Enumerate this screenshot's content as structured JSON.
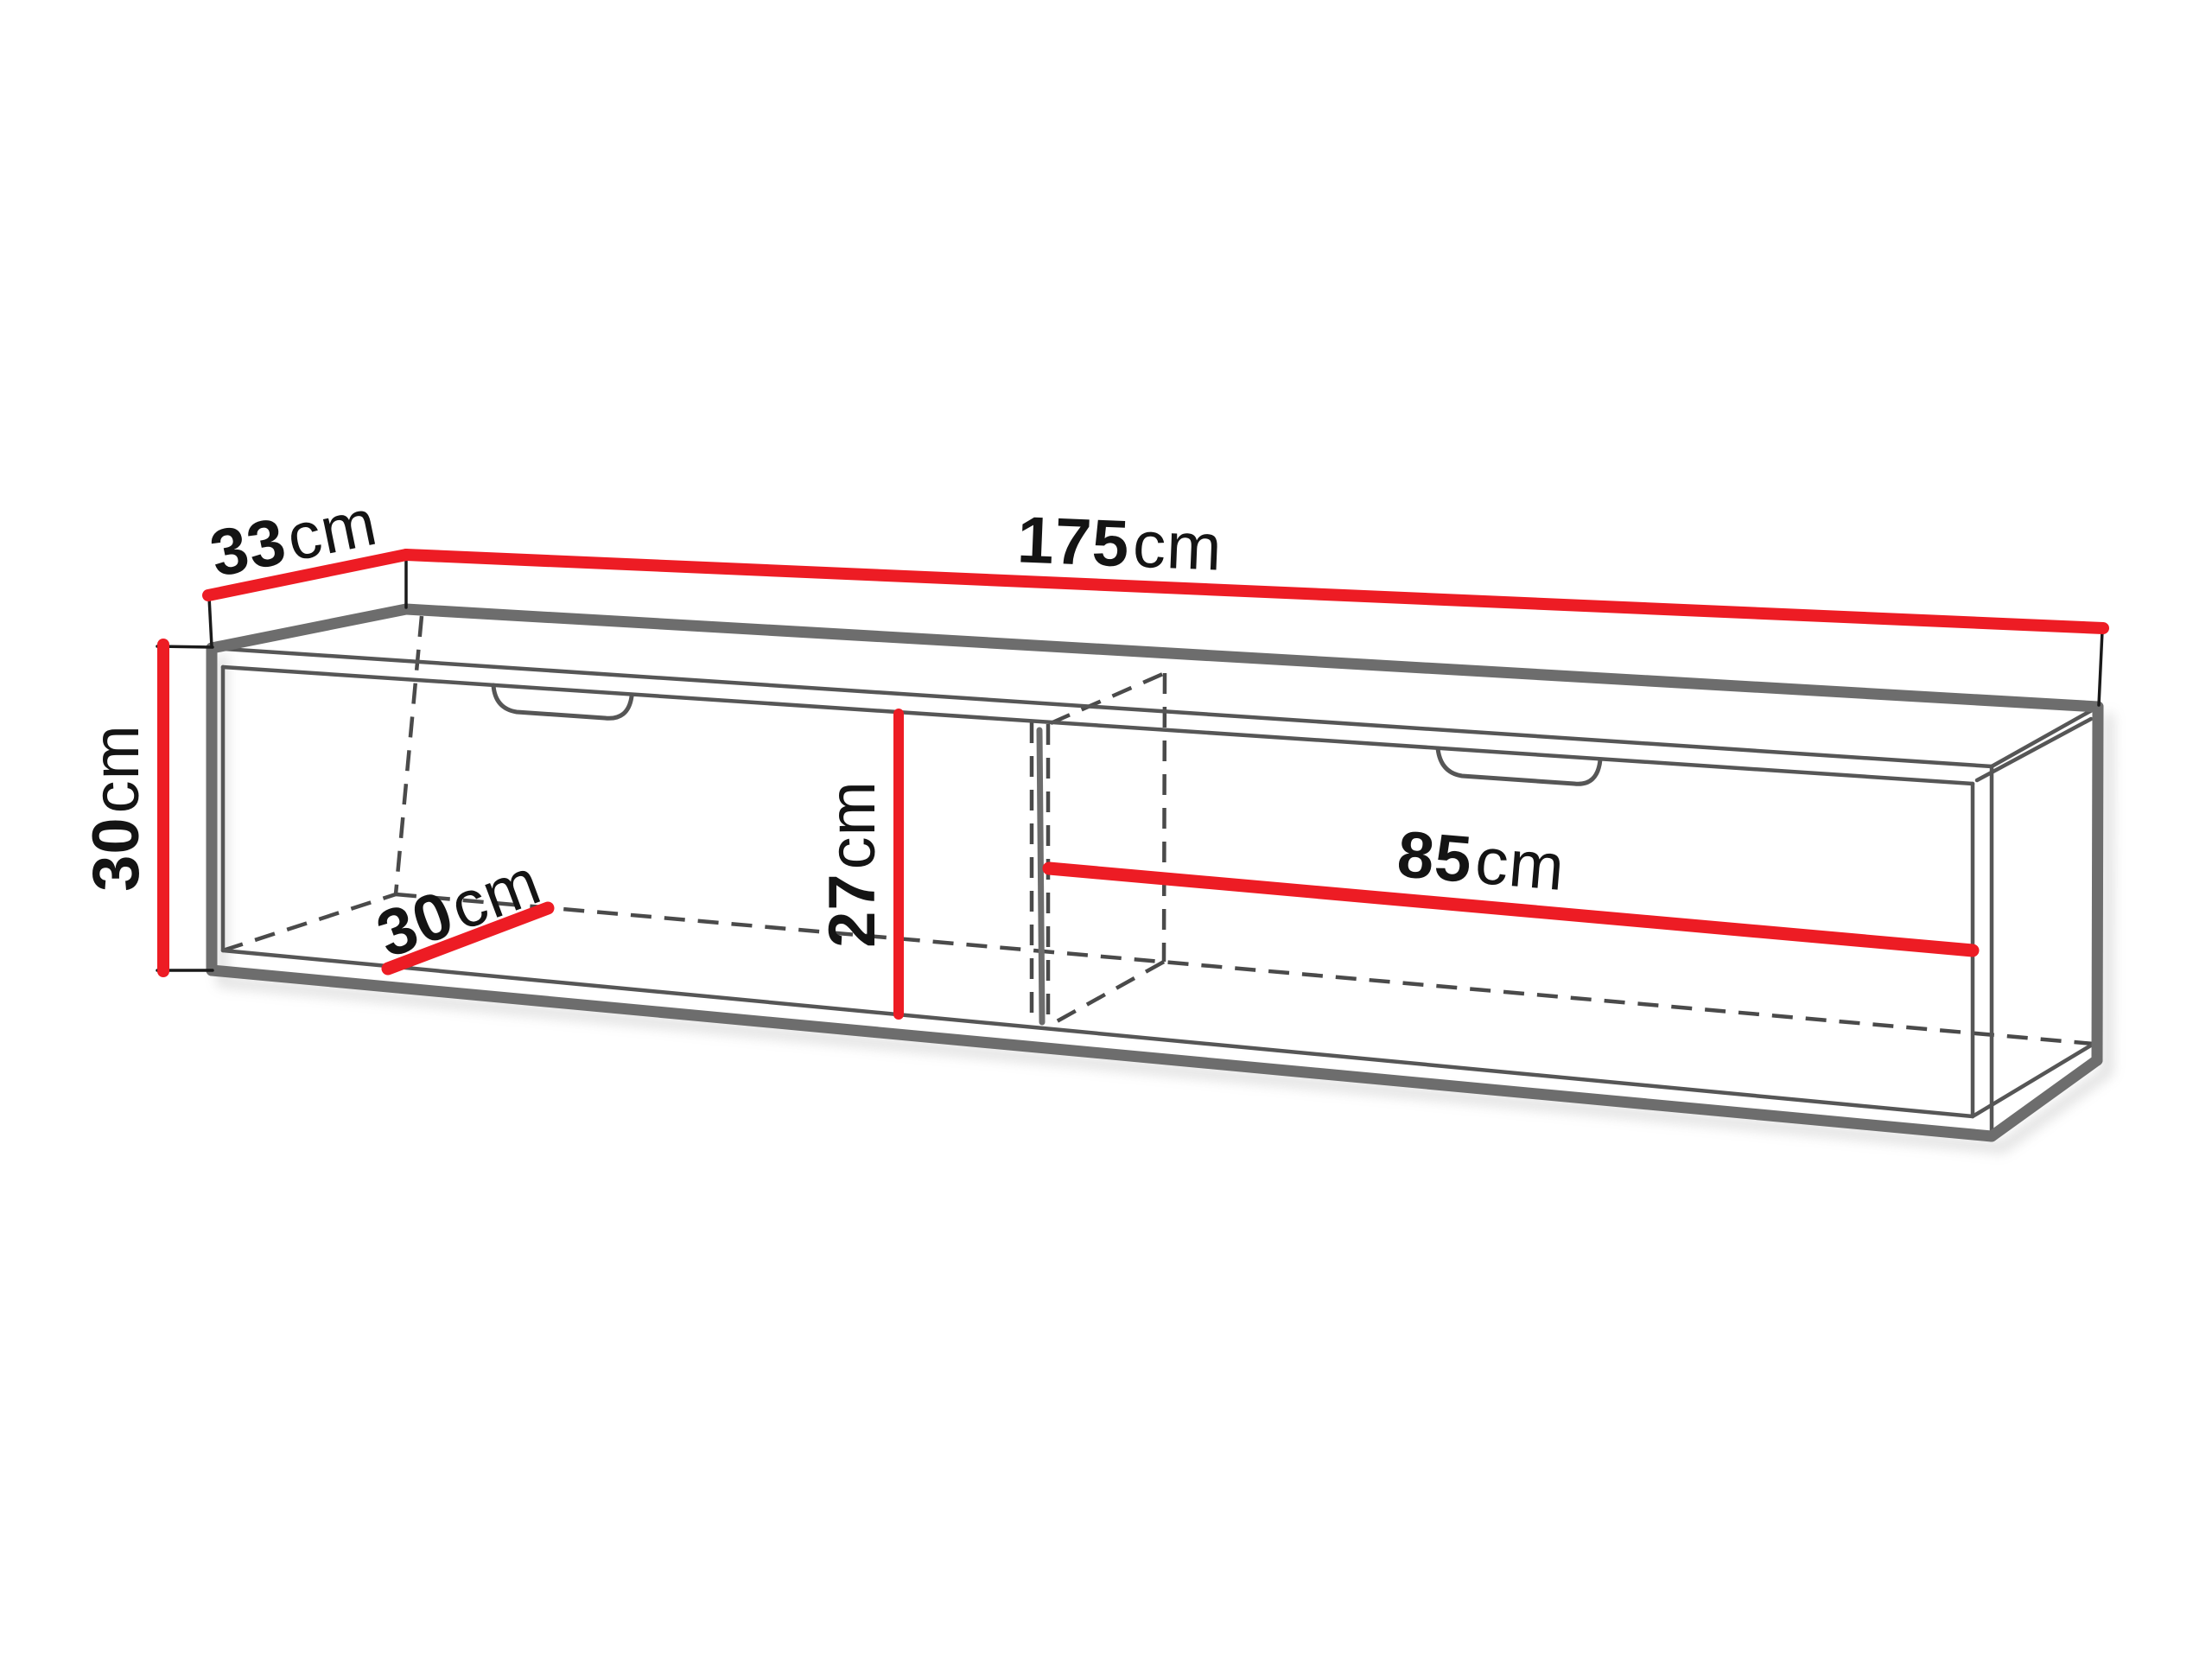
{
  "figure": {
    "kind": "furniture dimension diagram",
    "subject": "wall cabinet with two drawer fronts, 3D outline view with red dimension lines"
  },
  "dimensions": {
    "depth": {
      "value": "33",
      "unit": "cm"
    },
    "width": {
      "value": "175",
      "unit": "cm"
    },
    "height": {
      "value": "30",
      "unit": "cm"
    },
    "inner_depth": {
      "value": "30",
      "unit": "cm"
    },
    "inner_height": {
      "value": "27",
      "unit": "cm"
    },
    "inner_width": {
      "value": "85",
      "unit": "cm"
    }
  },
  "colors": {
    "dimension_red": "#ed1c24",
    "outline_gray": "#6d6d6d",
    "edge_gray": "#565656",
    "hidden_gray": "#4a4a4a",
    "witness_black": "#1a1a1a",
    "text_black": "#141414",
    "background": "#ffffff"
  }
}
